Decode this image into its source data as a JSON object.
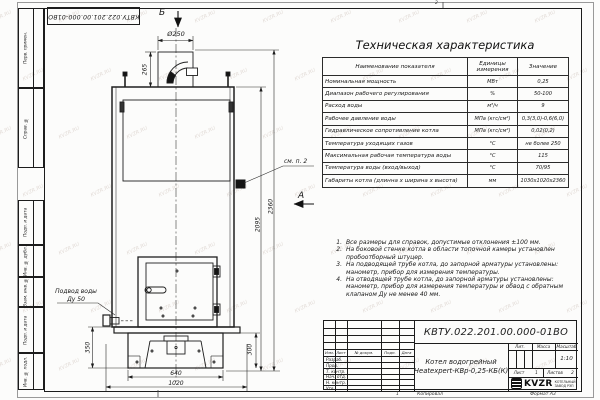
{
  "sheet": {
    "doc_number": "КВТУ.022.201.00.000-01ВО",
    "watermark": "KVZR.RU",
    "copied_label": "Копировал",
    "format_label": "Формат А3",
    "zone_top": "2",
    "zone_bottom": "1"
  },
  "margin_boxes": [
    "Перв. примен.",
    "Справ. №",
    "Подп. и дата",
    "Инв. № дубл.",
    "Взам. инв. №",
    "Подп. и дата",
    "Инв. № подл."
  ],
  "spec_table": {
    "title": "Техническая характеристика",
    "headers": [
      "Наименование показателя",
      "Единицы измерения",
      "Значение"
    ],
    "rows": [
      [
        "Номинальная мощность",
        "МВт",
        "0,25"
      ],
      [
        "Диапазон рабочего регулирования",
        "%",
        "50-100"
      ],
      [
        "Расход воды",
        "м³/ч",
        "9"
      ],
      [
        "Рабочее давление воды",
        "МПа (кгс/см²)",
        "0,3(3,0)-0,6(6,0)"
      ],
      [
        "Гидравлическое сопротивление котла",
        "МПа (кгс/см²)",
        "0,02(0,2)"
      ],
      [
        "Температура уходящих газов",
        "°С",
        "не более 250"
      ],
      [
        "Максимальная рабочая температура воды",
        "°С",
        "115"
      ],
      [
        "Температура воды (вход/выход)",
        "°С",
        "70/95"
      ],
      [
        "Габариты котла (длинна х ширина х высота)",
        "мм",
        "1030х1020х2360"
      ]
    ]
  },
  "notes": [
    {
      "n": "1.",
      "text": "Все размеры для справок, допустимые отклонения ±100 мм."
    },
    {
      "n": "2.",
      "text": "На боковой стенке котла в области топочной камеры установлен пробоотборный штуцер."
    },
    {
      "n": "3.",
      "text": "На подводящей трубе котла, до запорной арматуры установлены: манометр, прибор для измерения температуры."
    },
    {
      "n": "4.",
      "text": "На отводящей трубе котла, до запорной арматуры установлены: манометр, прибор для измерения температуры и обвод с обратным клапаном Ду не менее 40 мм."
    }
  ],
  "drawing": {
    "view_b_label": "Б",
    "view_a_label": "А",
    "dim_diameter": "Ø250",
    "dim_265": "265",
    "dim_2360": "2360",
    "dim_2095": "2095",
    "dim_350": "350",
    "dim_300": "300",
    "dim_640": "640",
    "dim_1020": "1020",
    "callout_note2": "см. п. 2",
    "water_inlet_line1": "Подвод воды",
    "water_inlet_line2": "Ду 50"
  },
  "title_block": {
    "product_name_line1": "Котел водогрейный",
    "product_name_line2": "Heatexpert-КВр-0,25-КБ(К)",
    "header_cells": [
      "Изм.",
      "Лист",
      "№ докум.",
      "Подп.",
      "Дата"
    ],
    "role_rows": [
      "Разраб.",
      "Пров.",
      "Т. контр.",
      "Нач. отд.",
      "Н. контр.",
      "Утв."
    ],
    "lit_label": "Лит.",
    "mass_label": "Масса",
    "scale_label": "Масштаб",
    "scale_value": "1:10",
    "sheet_label": "Лист",
    "sheet_value": "1",
    "sheets_label": "Листов",
    "sheets_value": "2",
    "logo_text": "KVZR",
    "logo_caption_line1": "КОТЕЛЬНЫЙ",
    "logo_caption_line2": "ЗАВОД РЭП"
  }
}
